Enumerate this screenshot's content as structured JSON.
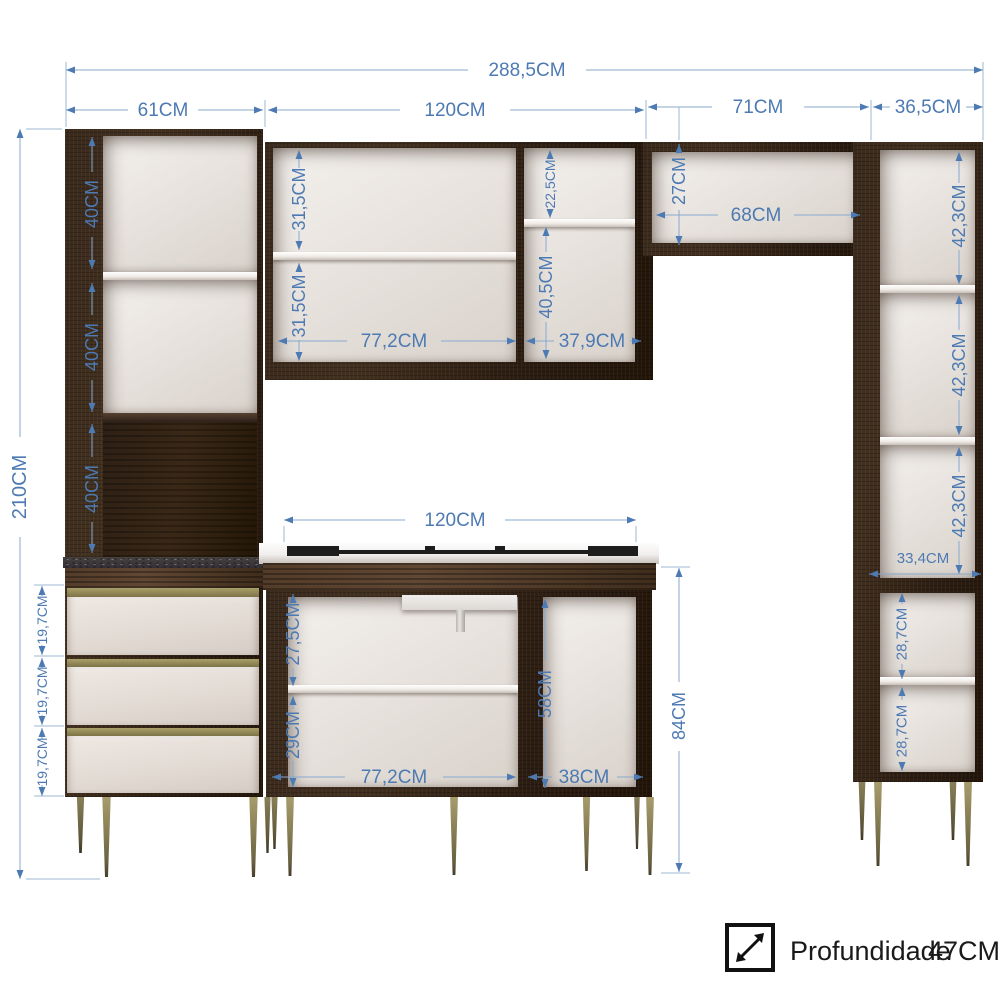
{
  "diagram": {
    "type": "kitchen-cabinet-set-dimension-diagram",
    "unit": "CM",
    "top_dims": {
      "total_width": "288,5CM",
      "left_tower_width": "61CM",
      "upper_cabinet_width": "120CM",
      "bridge_width": "71CM",
      "right_tower_width": "36,5CM"
    },
    "left_tower": {
      "total_height": "210CM",
      "section_1": "40CM",
      "section_2": "40CM",
      "section_3": "40CM",
      "drawer_1": "19,7CM",
      "drawer_2": "19,7CM",
      "drawer_3": "19,7CM"
    },
    "upper_cabinet": {
      "left_top": "31,5CM",
      "left_bottom": "31,5CM",
      "left_width": "77,2CM",
      "right_top": "22,5CM",
      "right_bottom": "40,5CM",
      "right_width": "37,9CM"
    },
    "bridge": {
      "height": "27CM",
      "width": "68CM"
    },
    "right_tower": {
      "section_1": "42,3CM",
      "section_2": "42,3CM",
      "section_3": "42,3CM",
      "inner_width": "33,4CM",
      "section_4": "28,7CM",
      "section_5": "28,7CM"
    },
    "base_cabinet": {
      "width": "120CM",
      "left_top": "27,5CM",
      "left_bottom": "29CM",
      "left_width": "77,2CM",
      "right_height": "58CM",
      "right_width": "38CM",
      "total_height": "84CM"
    },
    "footer": {
      "depth_icon": "diagonal-depth-arrow-icon",
      "depth_label": "Profundidade",
      "depth_value": "47CM"
    },
    "colors": {
      "dimension_blue": "#4d7ab2",
      "dimension_line_blue": "#87a9cf",
      "cabinet_dark_wood": "#32241a",
      "interior_cream": "#e6e0da",
      "trim_olive": "#958c58",
      "granite_gray": "#3b383b",
      "footer_text": "#1a1a1a"
    }
  }
}
